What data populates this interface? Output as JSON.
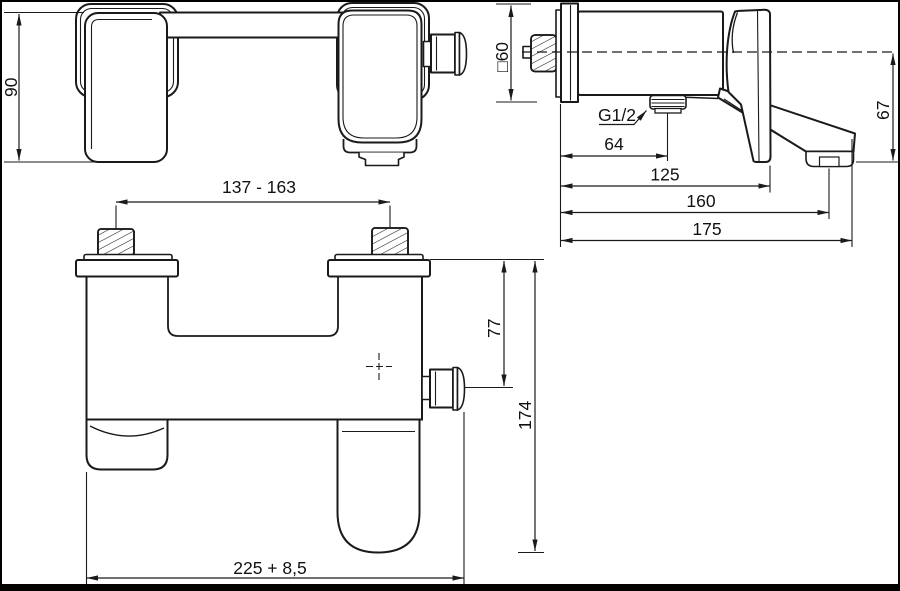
{
  "drawing": {
    "colors": {
      "background": "#ffffff",
      "line": "#1a1a1a",
      "frame": "#000000"
    },
    "front_view": {
      "dim_height": "90",
      "dim_hole_spacing": "137 - 163"
    },
    "side_view": {
      "dim_square": "□60",
      "thread_label": "G1/2",
      "dim_outlet_offset": "64",
      "dim_handle_depth": "125",
      "dim_aerator_reach": "160",
      "dim_spout_reach": "175",
      "dim_spout_drop": "67"
    },
    "plan_view": {
      "dim_diverter_offset": "77",
      "dim_total_depth": "174",
      "dim_overall_width": "225 + 8,5"
    }
  }
}
